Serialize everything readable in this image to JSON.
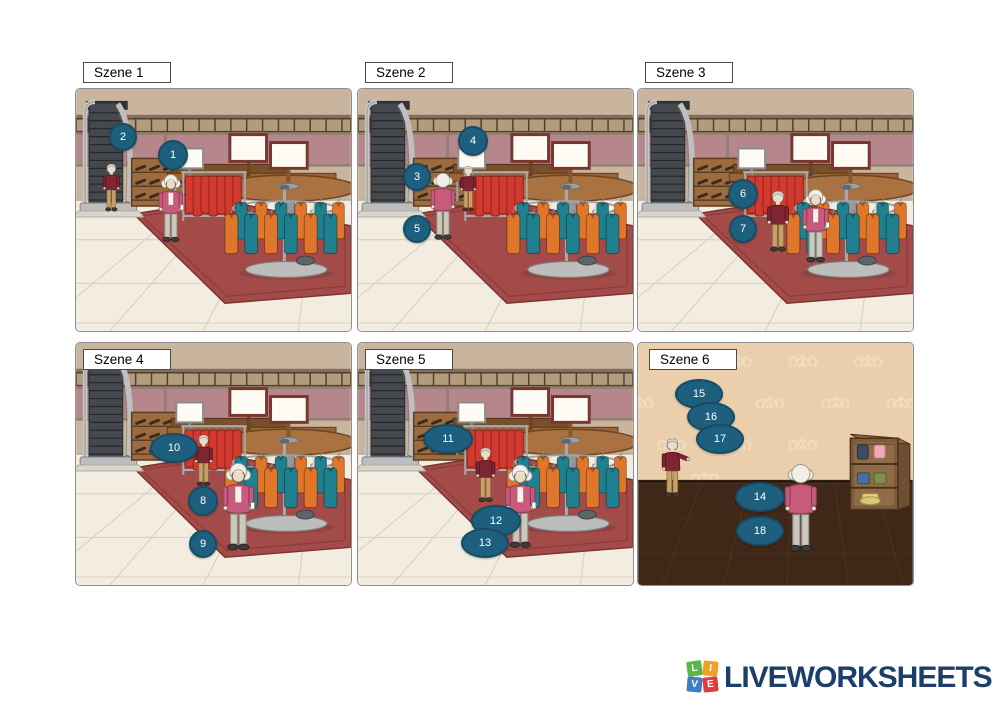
{
  "scenes": [
    {
      "label": "Szene 1",
      "markers": [
        {
          "n": "2",
          "x": 47,
          "y": 48,
          "rx": 14,
          "ry": 14
        },
        {
          "n": "1",
          "x": 97,
          "y": 66,
          "rx": 15,
          "ry": 15
        }
      ]
    },
    {
      "label": "Szene 2",
      "markers": [
        {
          "n": "4",
          "x": 115,
          "y": 52,
          "rx": 15,
          "ry": 15
        },
        {
          "n": "3",
          "x": 59,
          "y": 88,
          "rx": 14,
          "ry": 14
        },
        {
          "n": "5",
          "x": 59,
          "y": 140,
          "rx": 14,
          "ry": 14
        }
      ]
    },
    {
      "label": "Szene 3",
      "markers": [
        {
          "n": "6",
          "x": 105,
          "y": 105,
          "rx": 15,
          "ry": 15
        },
        {
          "n": "7",
          "x": 105,
          "y": 140,
          "rx": 14,
          "ry": 14
        }
      ]
    },
    {
      "label": "Szene 4",
      "markers": [
        {
          "n": "10",
          "x": 98,
          "y": 105,
          "rx": 24,
          "ry": 15
        },
        {
          "n": "8",
          "x": 127,
          "y": 158,
          "rx": 15,
          "ry": 15
        },
        {
          "n": "9",
          "x": 127,
          "y": 201,
          "rx": 14,
          "ry": 14
        }
      ]
    },
    {
      "label": "Szene 5",
      "markers": [
        {
          "n": "11",
          "x": 90,
          "y": 96,
          "rx": 25,
          "ry": 15
        },
        {
          "n": "12",
          "x": 138,
          "y": 178,
          "rx": 25,
          "ry": 16
        },
        {
          "n": "13",
          "x": 127,
          "y": 200,
          "rx": 24,
          "ry": 15
        }
      ]
    },
    {
      "label": "Szene 6",
      "markers": [
        {
          "n": "15",
          "x": 61,
          "y": 51,
          "rx": 24,
          "ry": 15
        },
        {
          "n": "16",
          "x": 73,
          "y": 74,
          "rx": 24,
          "ry": 15
        },
        {
          "n": "17",
          "x": 82,
          "y": 96,
          "rx": 24,
          "ry": 15
        },
        {
          "n": "14",
          "x": 122,
          "y": 154,
          "rx": 25,
          "ry": 15
        },
        {
          "n": "18",
          "x": 122,
          "y": 188,
          "rx": 24,
          "ry": 15
        }
      ]
    }
  ],
  "colors": {
    "marker_fill": "#1E5F7E",
    "marker_border": "#164C66",
    "marker_text": "#FFFFFF"
  },
  "footer": {
    "brand": "LIVEWORKSHEETS",
    "text_color": "#1C3E6B",
    "tiles": [
      {
        "letter": "L",
        "color": "#5BB647"
      },
      {
        "letter": "I",
        "color": "#F0A028"
      },
      {
        "letter": "V",
        "color": "#3F7EC6"
      },
      {
        "letter": "E",
        "color": "#E03E3E"
      }
    ]
  }
}
